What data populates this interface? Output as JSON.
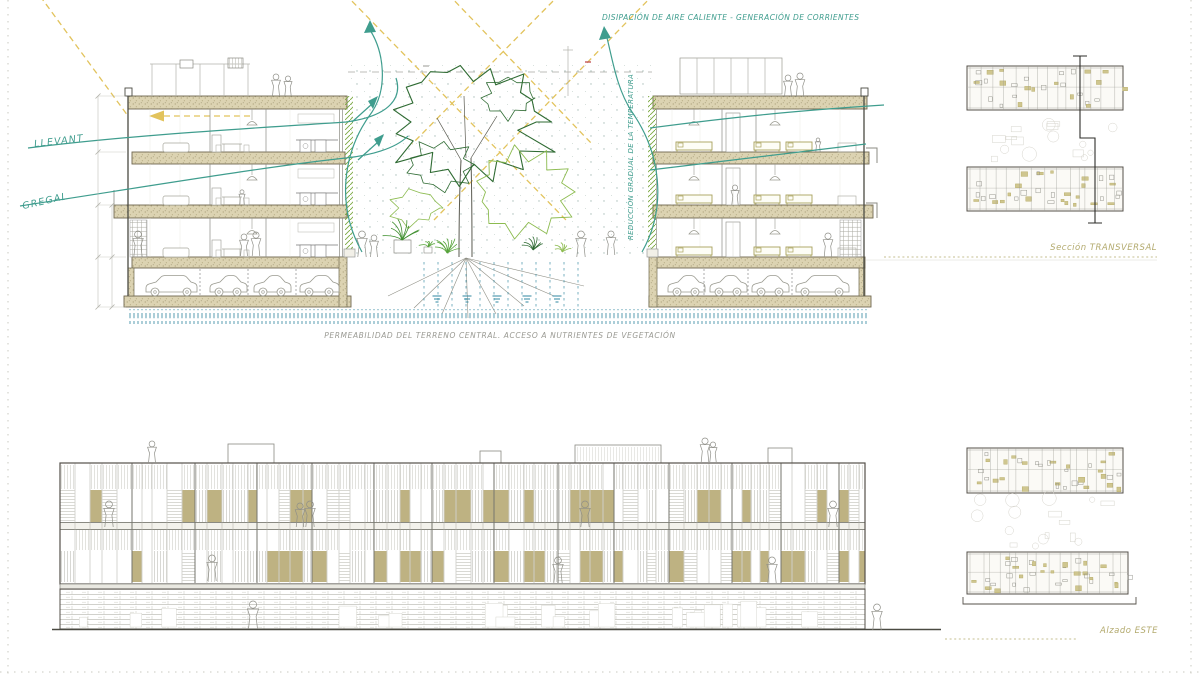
{
  "annotations": {
    "heat_dissipation": "DISIPACIÓN DE AIRE CALIENTE - GENERACIÓN DE CORRIENTES",
    "wind_llevant": "LLEVANT",
    "wind_gregal": "GREGAL",
    "temperature_gradient": "REDUCCIÓN GRADUAL DE LA TEMPERATURA",
    "permeability": "PERMEABILIDAD DEL TERRENO CENTRAL. ACCESO A NUTRIENTES DE VEGETACIÓN"
  },
  "view_labels": {
    "section": "Sección TRANSVERSAL",
    "elevation": "Alzado ESTE"
  },
  "colors": {
    "teal": "#3f9d8e",
    "sun_yellow": "#e2c35c",
    "olive_label": "#b3aa6e",
    "slab_beige": "#dcd3b2",
    "panel_tan": "#b7aa74",
    "tree_green": "#2f6b33",
    "light_green": "#8cbb4f",
    "vegetation_green": "#7aa83e",
    "sketch_gray": "#9b9b93",
    "permeability_teal": "#2f87a0"
  }
}
